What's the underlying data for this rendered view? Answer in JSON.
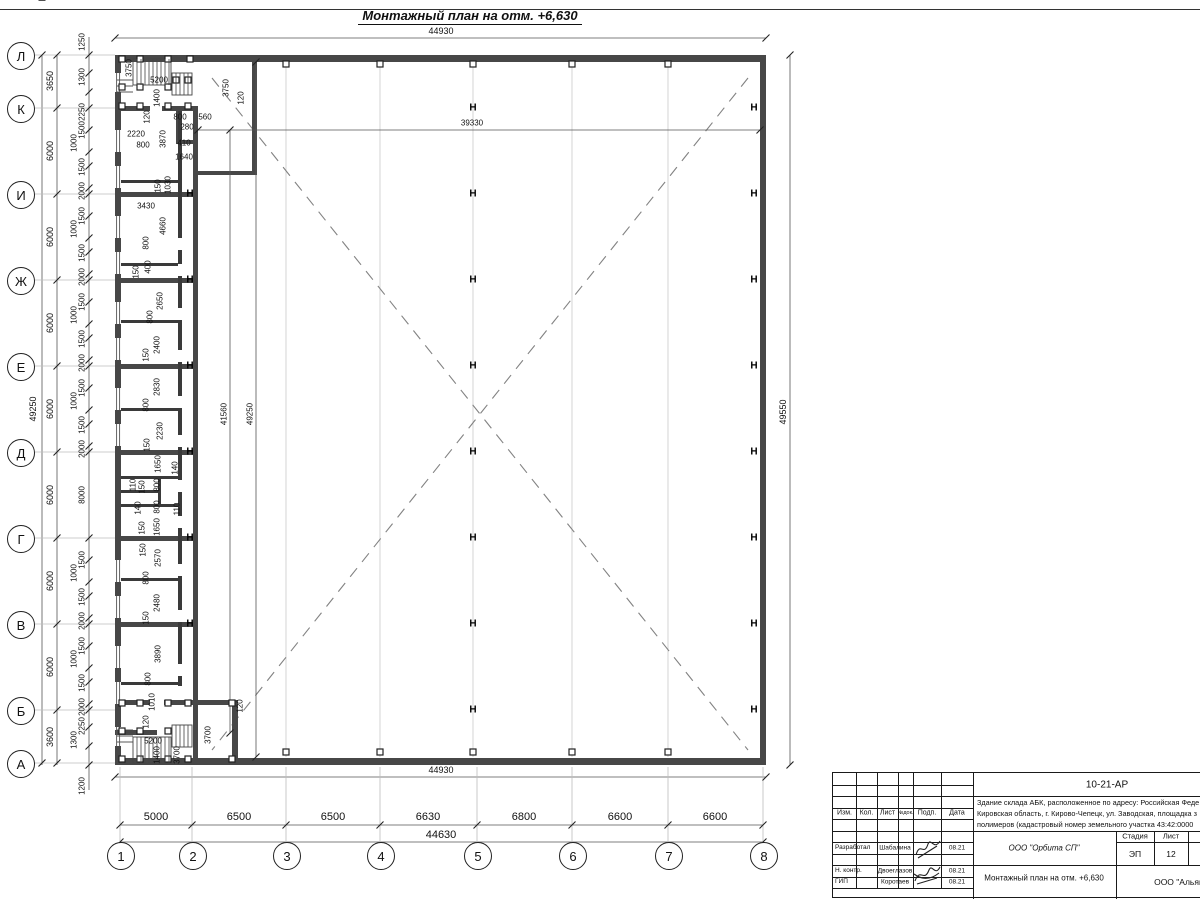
{
  "title": "Монтажный план на отм. +6,630",
  "plan": {
    "row_axes": [
      {
        "label": "Л",
        "y": 55
      },
      {
        "label": "К",
        "y": 108
      },
      {
        "label": "И",
        "y": 194
      },
      {
        "label": "Ж",
        "y": 280
      },
      {
        "label": "Е",
        "y": 366
      },
      {
        "label": "Д",
        "y": 452
      },
      {
        "label": "Г",
        "y": 538
      },
      {
        "label": "В",
        "y": 624
      },
      {
        "label": "Б",
        "y": 710
      },
      {
        "label": "А",
        "y": 763
      }
    ],
    "col_axes": [
      {
        "label": "1",
        "x": 120
      },
      {
        "label": "2",
        "x": 192
      },
      {
        "label": "3",
        "x": 286
      },
      {
        "label": "4",
        "x": 380
      },
      {
        "label": "5",
        "x": 477
      },
      {
        "label": "6",
        "x": 572
      },
      {
        "label": "7",
        "x": 668
      },
      {
        "label": "8",
        "x": 763
      }
    ],
    "columns": [
      {
        "x": 190,
        "ys": [
          194,
          280,
          366,
          452,
          538,
          624
        ]
      },
      {
        "x": 473,
        "ys": [
          108,
          194,
          280,
          366,
          452,
          538,
          624,
          710
        ]
      },
      {
        "x": 754,
        "ys": [
          108,
          194,
          280,
          366,
          452,
          538,
          624,
          710
        ]
      }
    ],
    "squares": [
      [
        286,
        64
      ],
      [
        380,
        64
      ],
      [
        473,
        64
      ],
      [
        572,
        64
      ],
      [
        668,
        64
      ],
      [
        286,
        752
      ],
      [
        380,
        752
      ],
      [
        473,
        752
      ],
      [
        572,
        752
      ],
      [
        668,
        752
      ],
      [
        122,
        59
      ],
      [
        140,
        59
      ],
      [
        168,
        59
      ],
      [
        190,
        59
      ],
      [
        122,
        87
      ],
      [
        140,
        87
      ],
      [
        168,
        87
      ],
      [
        176,
        80
      ],
      [
        188,
        80
      ],
      [
        122,
        106
      ],
      [
        140,
        106
      ],
      [
        168,
        106
      ],
      [
        188,
        106
      ],
      [
        122,
        703
      ],
      [
        140,
        703
      ],
      [
        168,
        703
      ],
      [
        188,
        703
      ],
      [
        232,
        703
      ],
      [
        122,
        731
      ],
      [
        140,
        731
      ],
      [
        168,
        731
      ],
      [
        122,
        759
      ],
      [
        140,
        759
      ],
      [
        168,
        759
      ],
      [
        188,
        759
      ],
      [
        232,
        759
      ]
    ],
    "labels": [
      {
        "t": "44930",
        "x": 441,
        "y": 31,
        "c": "med"
      },
      {
        "t": "39330",
        "x": 472,
        "y": 123
      },
      {
        "t": "560",
        "x": 205,
        "y": 117
      },
      {
        "t": "800",
        "x": 180,
        "y": 117
      },
      {
        "t": "280",
        "x": 187,
        "y": 127
      },
      {
        "t": "410",
        "x": 184,
        "y": 143
      },
      {
        "t": "1640",
        "x": 184,
        "y": 157
      },
      {
        "t": "2220",
        "x": 136,
        "y": 134
      },
      {
        "t": "800",
        "x": 143,
        "y": 145
      },
      {
        "t": "3870",
        "x": 163,
        "y": 139,
        "r": 1
      },
      {
        "t": "120",
        "x": 147,
        "y": 117,
        "r": 1
      },
      {
        "t": "1400",
        "x": 157,
        "y": 98,
        "r": 1
      },
      {
        "t": "5200",
        "x": 159,
        "y": 80
      },
      {
        "t": "3750",
        "x": 129,
        "y": 68,
        "r": 1
      },
      {
        "t": "3750",
        "x": 226,
        "y": 88,
        "r": 1
      },
      {
        "t": "120",
        "x": 241,
        "y": 98,
        "r": 1
      },
      {
        "t": "1250",
        "x": 82,
        "y": 42,
        "r": 1
      },
      {
        "t": "1300",
        "x": 82,
        "y": 77,
        "r": 1
      },
      {
        "t": "2250",
        "x": 82,
        "y": 112,
        "r": 1
      },
      {
        "t": "1500",
        "x": 82,
        "y": 130,
        "r": 1
      },
      {
        "t": "1000",
        "x": 74,
        "y": 143,
        "r": 1
      },
      {
        "t": "1500",
        "x": 82,
        "y": 167,
        "r": 1
      },
      {
        "t": "2000",
        "x": 82,
        "y": 191,
        "r": 1
      },
      {
        "t": "1500",
        "x": 82,
        "y": 216,
        "r": 1
      },
      {
        "t": "1000",
        "x": 74,
        "y": 229,
        "r": 1
      },
      {
        "t": "1500",
        "x": 82,
        "y": 253,
        "r": 1
      },
      {
        "t": "2000",
        "x": 82,
        "y": 277,
        "r": 1
      },
      {
        "t": "1500",
        "x": 82,
        "y": 302,
        "r": 1
      },
      {
        "t": "1000",
        "x": 74,
        "y": 315,
        "r": 1
      },
      {
        "t": "1500",
        "x": 82,
        "y": 339,
        "r": 1
      },
      {
        "t": "2000",
        "x": 82,
        "y": 363,
        "r": 1
      },
      {
        "t": "1500",
        "x": 82,
        "y": 388,
        "r": 1
      },
      {
        "t": "1000",
        "x": 74,
        "y": 401,
        "r": 1
      },
      {
        "t": "1500",
        "x": 82,
        "y": 425,
        "r": 1
      },
      {
        "t": "2000",
        "x": 82,
        "y": 449,
        "r": 1
      },
      {
        "t": "8000",
        "x": 82,
        "y": 495,
        "r": 1
      },
      {
        "t": "1500",
        "x": 82,
        "y": 560,
        "r": 1
      },
      {
        "t": "1000",
        "x": 74,
        "y": 573,
        "r": 1
      },
      {
        "t": "1500",
        "x": 82,
        "y": 597,
        "r": 1
      },
      {
        "t": "2000",
        "x": 82,
        "y": 621,
        "r": 1
      },
      {
        "t": "1500",
        "x": 82,
        "y": 646,
        "r": 1
      },
      {
        "t": "1000",
        "x": 74,
        "y": 659,
        "r": 1
      },
      {
        "t": "1500",
        "x": 82,
        "y": 683,
        "r": 1
      },
      {
        "t": "2000",
        "x": 82,
        "y": 707,
        "r": 1
      },
      {
        "t": "2250",
        "x": 82,
        "y": 726,
        "r": 1
      },
      {
        "t": "1300",
        "x": 74,
        "y": 740,
        "r": 1
      },
      {
        "t": "1200",
        "x": 82,
        "y": 786,
        "r": 1
      },
      {
        "t": "3650",
        "x": 50,
        "y": 81,
        "r": 1,
        "c": "med"
      },
      {
        "t": "6000",
        "x": 50,
        "y": 151,
        "r": 1,
        "c": "med"
      },
      {
        "t": "6000",
        "x": 50,
        "y": 237,
        "r": 1,
        "c": "med"
      },
      {
        "t": "6000",
        "x": 50,
        "y": 323,
        "r": 1,
        "c": "med"
      },
      {
        "t": "6000",
        "x": 50,
        "y": 409,
        "r": 1,
        "c": "med"
      },
      {
        "t": "6000",
        "x": 50,
        "y": 495,
        "r": 1,
        "c": "med"
      },
      {
        "t": "6000",
        "x": 50,
        "y": 581,
        "r": 1,
        "c": "med"
      },
      {
        "t": "6000",
        "x": 50,
        "y": 667,
        "r": 1,
        "c": "med"
      },
      {
        "t": "3600",
        "x": 50,
        "y": 737,
        "r": 1,
        "c": "med"
      },
      {
        "t": "49250",
        "x": 33,
        "y": 409,
        "r": 1,
        "c": "med"
      },
      {
        "t": "49550",
        "x": 783,
        "y": 412,
        "r": 1,
        "c": "med"
      },
      {
        "t": "41560",
        "x": 224,
        "y": 414,
        "r": 1
      },
      {
        "t": "49250",
        "x": 250,
        "y": 414,
        "r": 1
      },
      {
        "t": "150",
        "x": 158,
        "y": 186,
        "r": 1
      },
      {
        "t": "1030",
        "x": 168,
        "y": 185,
        "r": 1
      },
      {
        "t": "3430",
        "x": 146,
        "y": 206
      },
      {
        "t": "4660",
        "x": 163,
        "y": 226,
        "r": 1
      },
      {
        "t": "800",
        "x": 146,
        "y": 243,
        "r": 1
      },
      {
        "t": "400",
        "x": 148,
        "y": 267,
        "r": 1
      },
      {
        "t": "150",
        "x": 136,
        "y": 272,
        "r": 1
      },
      {
        "t": "2650",
        "x": 160,
        "y": 301,
        "r": 1
      },
      {
        "t": "800",
        "x": 150,
        "y": 317,
        "r": 1
      },
      {
        "t": "2400",
        "x": 157,
        "y": 345,
        "r": 1
      },
      {
        "t": "150",
        "x": 146,
        "y": 355,
        "r": 1
      },
      {
        "t": "2830",
        "x": 157,
        "y": 387,
        "r": 1
      },
      {
        "t": "800",
        "x": 146,
        "y": 405,
        "r": 1
      },
      {
        "t": "2230",
        "x": 160,
        "y": 431,
        "r": 1
      },
      {
        "t": "150",
        "x": 147,
        "y": 445,
        "r": 1
      },
      {
        "t": "1650",
        "x": 158,
        "y": 464,
        "r": 1
      },
      {
        "t": "140",
        "x": 175,
        "y": 468,
        "r": 1
      },
      {
        "t": "110",
        "x": 133,
        "y": 485,
        "r": 1
      },
      {
        "t": "150",
        "x": 142,
        "y": 487,
        "r": 1
      },
      {
        "t": "800",
        "x": 157,
        "y": 485,
        "r": 1
      },
      {
        "t": "800",
        "x": 157,
        "y": 507,
        "r": 1
      },
      {
        "t": "140",
        "x": 138,
        "y": 508,
        "r": 1
      },
      {
        "t": "110",
        "x": 177,
        "y": 509,
        "r": 1
      },
      {
        "t": "1650",
        "x": 157,
        "y": 527,
        "r": 1
      },
      {
        "t": "150",
        "x": 142,
        "y": 528,
        "r": 1
      },
      {
        "t": "150",
        "x": 143,
        "y": 550,
        "r": 1
      },
      {
        "t": "2570",
        "x": 158,
        "y": 558,
        "r": 1
      },
      {
        "t": "800",
        "x": 146,
        "y": 578,
        "r": 1
      },
      {
        "t": "2480",
        "x": 157,
        "y": 603,
        "r": 1
      },
      {
        "t": "150",
        "x": 146,
        "y": 618,
        "r": 1
      },
      {
        "t": "3890",
        "x": 158,
        "y": 654,
        "r": 1
      },
      {
        "t": "800",
        "x": 148,
        "y": 679,
        "r": 1
      },
      {
        "t": "1010",
        "x": 152,
        "y": 702,
        "r": 1
      },
      {
        "t": "120",
        "x": 146,
        "y": 722,
        "r": 1
      },
      {
        "t": "5200",
        "x": 153,
        "y": 741
      },
      {
        "t": "1400",
        "x": 157,
        "y": 755,
        "r": 1
      },
      {
        "t": "3700",
        "x": 177,
        "y": 755,
        "r": 1
      },
      {
        "t": "3700",
        "x": 208,
        "y": 735,
        "r": 1
      },
      {
        "t": "120",
        "x": 240,
        "y": 706,
        "r": 1
      },
      {
        "t": "44930",
        "x": 441,
        "y": 770,
        "c": "med"
      },
      {
        "t": "5000",
        "x": 156,
        "y": 817,
        "c": "big"
      },
      {
        "t": "6500",
        "x": 239,
        "y": 817,
        "c": "big"
      },
      {
        "t": "6500",
        "x": 333,
        "y": 817,
        "c": "big"
      },
      {
        "t": "6630",
        "x": 428,
        "y": 817,
        "c": "big"
      },
      {
        "t": "6800",
        "x": 524,
        "y": 817,
        "c": "big"
      },
      {
        "t": "6600",
        "x": 620,
        "y": 817,
        "c": "big"
      },
      {
        "t": "6600",
        "x": 715,
        "y": 817,
        "c": "big"
      },
      {
        "t": "44630",
        "x": 441,
        "y": 835,
        "c": "big"
      }
    ]
  },
  "titleblock": {
    "code": "10-21-АР",
    "desc_lines": [
      "Здание склада АБК, расположенное по адресу: Российская Феде",
      "Кировская область, г. Кирово-Чепецк, ул. Заводская, площадка з",
      "полимеров (кадастровый номер земельного участка 43:42:0000"
    ],
    "header_cols": [
      "Изм.",
      "Кол.",
      "Лист",
      "№док.",
      "Подп.",
      "Дата"
    ],
    "rows": [
      {
        "role": "Разработал",
        "name": "Шабалина",
        "date": "08.21"
      },
      {
        "role": "Н. контр.",
        "name": "Двоеглазов",
        "date": "08.21"
      },
      {
        "role": "ГИП",
        "name": "Коротаев",
        "date": "08.21"
      }
    ],
    "org": "ООО \"Орбита СП\"",
    "stage_label": "Стадия",
    "sheet_label": "Лист",
    "sheets_label": "Листов",
    "stage": "ЭП",
    "sheet": "12",
    "sheets": "1",
    "doc_title": "Монтажный план на отм. +6,630",
    "company": "ООО \"Альянс"
  }
}
